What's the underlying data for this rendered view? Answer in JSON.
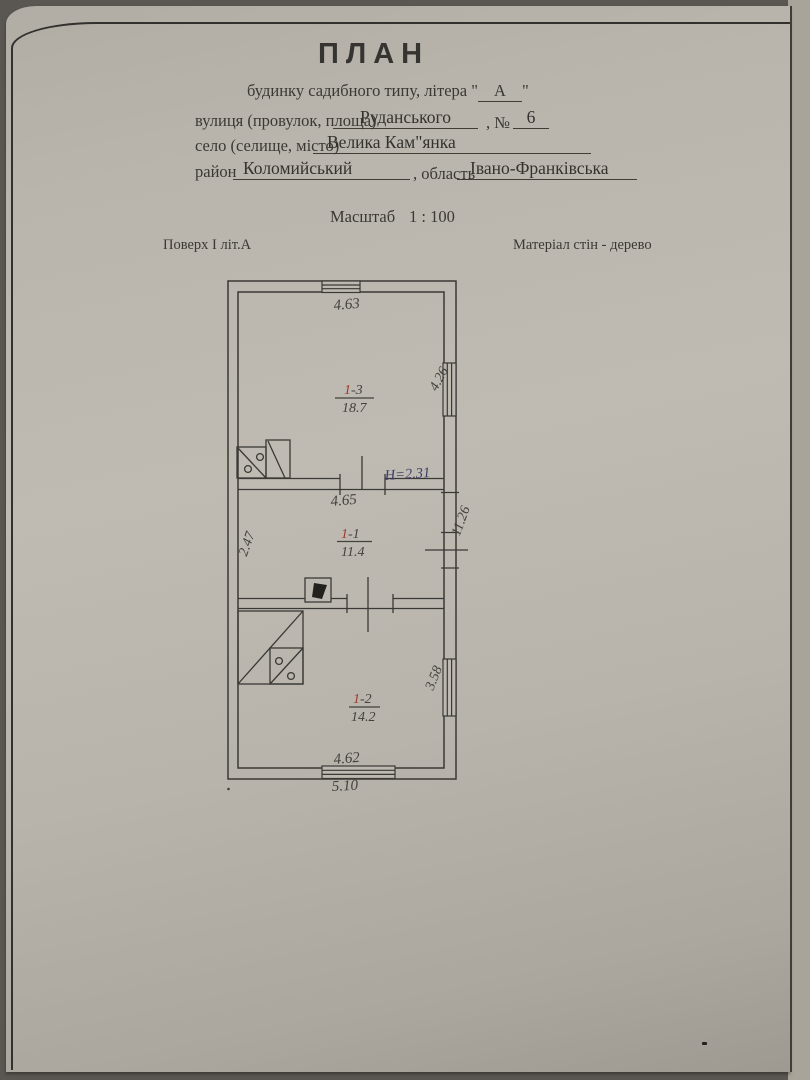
{
  "header": {
    "title": "ПЛАН",
    "subtitle_prefix": "будинку садибного типу, літера \"",
    "letter": "А",
    "subtitle_suffix": "\"",
    "street_label": "вулиця (провулок, площа)",
    "street_value": "Руданського",
    "number_label": ", №",
    "number_value": "6",
    "settlement_label": "село (селище, місто)",
    "settlement_value": "Велика Кам\"янка",
    "district_label": "район",
    "district_value": "Коломийський",
    "region_label": ", область",
    "region_value": "Івано-Франківська",
    "scale_label": "Масштаб",
    "scale_value": "1 : 100",
    "floor_note": "Поверх І літ.А",
    "material_note": "Матеріал стін - дерево"
  },
  "plan": {
    "rooms": [
      {
        "num": "1",
        "suffix": "-3",
        "area": "18.7"
      },
      {
        "num": "1",
        "suffix": "-1",
        "area": "11.4"
      },
      {
        "num": "1",
        "suffix": "-2",
        "area": "14.2"
      }
    ],
    "dimensions": {
      "top_width": "4.63",
      "window_right_upper": "4.26",
      "height_note": "Н=2.31",
      "middle_width": "4.65",
      "left_depth": "2.47",
      "right_total": "11.26",
      "window_right_lower": "3.58",
      "bottom_width_inner": "4.62",
      "bottom_width_outer": "5.10"
    }
  }
}
